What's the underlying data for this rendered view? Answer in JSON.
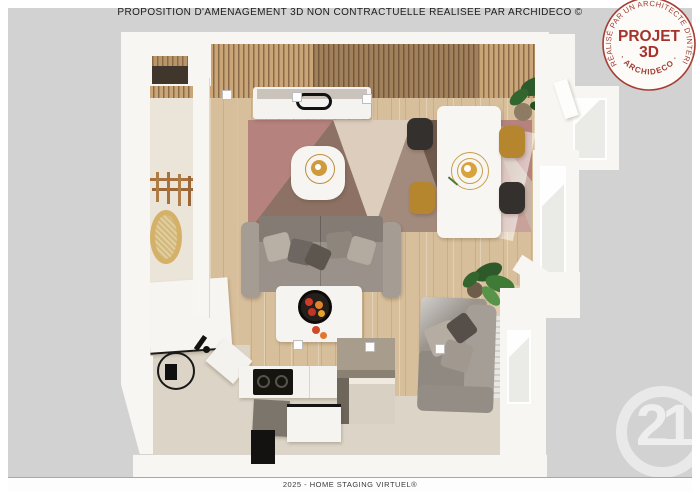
{
  "header": {
    "title": "PROPOSITION D'AMÉNAGEMENT 3D NON CONTRACTUELLE RÉALISÉE PAR ARCHIDECO ©"
  },
  "stamp": {
    "ring_top": "RÉALISÉ PAR UN ARCHITECTE D'INTÉRIEUR",
    "ring_bottom": "· ARCHIDECO ·",
    "title_line1": "PROJET",
    "title_line2": "3D",
    "text_color": "#a23730",
    "background": "#fdfbf8"
  },
  "footer": {
    "text": "2025 - HOME STAGING VIRTUEL®"
  },
  "watermark": {
    "brand_number": "21",
    "color": "rgba(255,255,255,0.55)"
  },
  "canvas": {
    "background": "#d2d2d2",
    "frame": "#ffffff"
  },
  "floorplan_palette": {
    "wood_floor": "#d8bf9b",
    "slat_ceiling": "#c9a577",
    "kitchen_floor": "#dcd5c7",
    "hallway_floor": "#ebe4d9",
    "walls": "#f8f6f3",
    "rug_base": "#c9b3a6",
    "rug_pink": "#b5827d",
    "rug_brown": "#8c7164",
    "sofa_gray": "#9a928a",
    "armchair_gray": "#96918a",
    "chair_black": "#33302d",
    "chair_mustard": "#b5862e",
    "plant_green": "#3f7a36",
    "fruit_red": "#d03c2c",
    "fruit_orange": "#e0832d"
  }
}
